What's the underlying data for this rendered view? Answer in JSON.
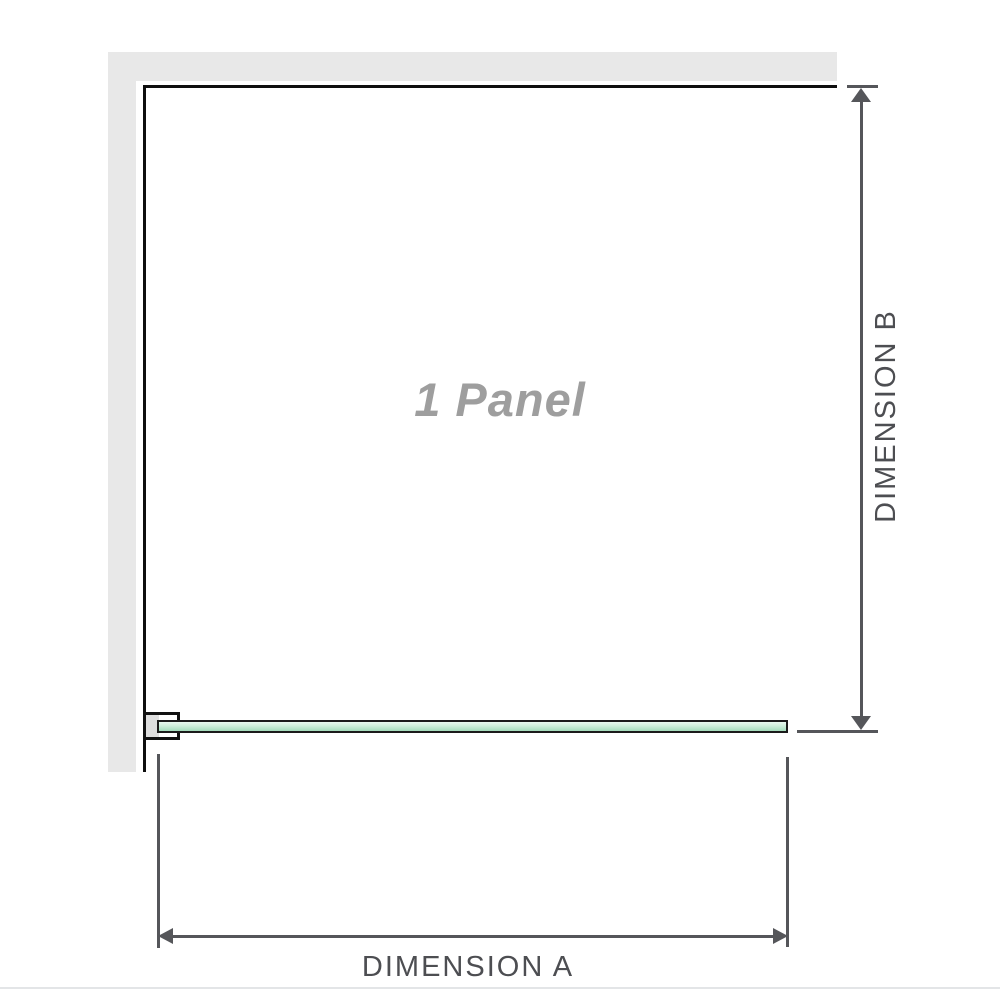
{
  "diagram": {
    "panel_label": "1 Panel",
    "dimension_a_label": "DIMENSION A",
    "dimension_b_label": "DIMENSION B"
  },
  "icons": {
    "arrow_up": "▲",
    "arrow_down": "▼",
    "arrow_left": "◀",
    "arrow_right": "▶"
  },
  "colors": {
    "background": "#ffffff",
    "wall_fill": "#e8e8e8",
    "wall_edge": "#0e0e0e",
    "dimension_line": "#55565a",
    "dimension_label_text": "#4d4e52",
    "panel_label_text": "#9e9e9e",
    "glass_fill_light": "#e9f8f0",
    "glass_fill_dark": "#a3dbbb",
    "glass_border": "#1b1b1b",
    "bracket_border": "#111111",
    "bracket_pad_fill": "#dedede",
    "bottom_divider": "#e3e5e7"
  }
}
